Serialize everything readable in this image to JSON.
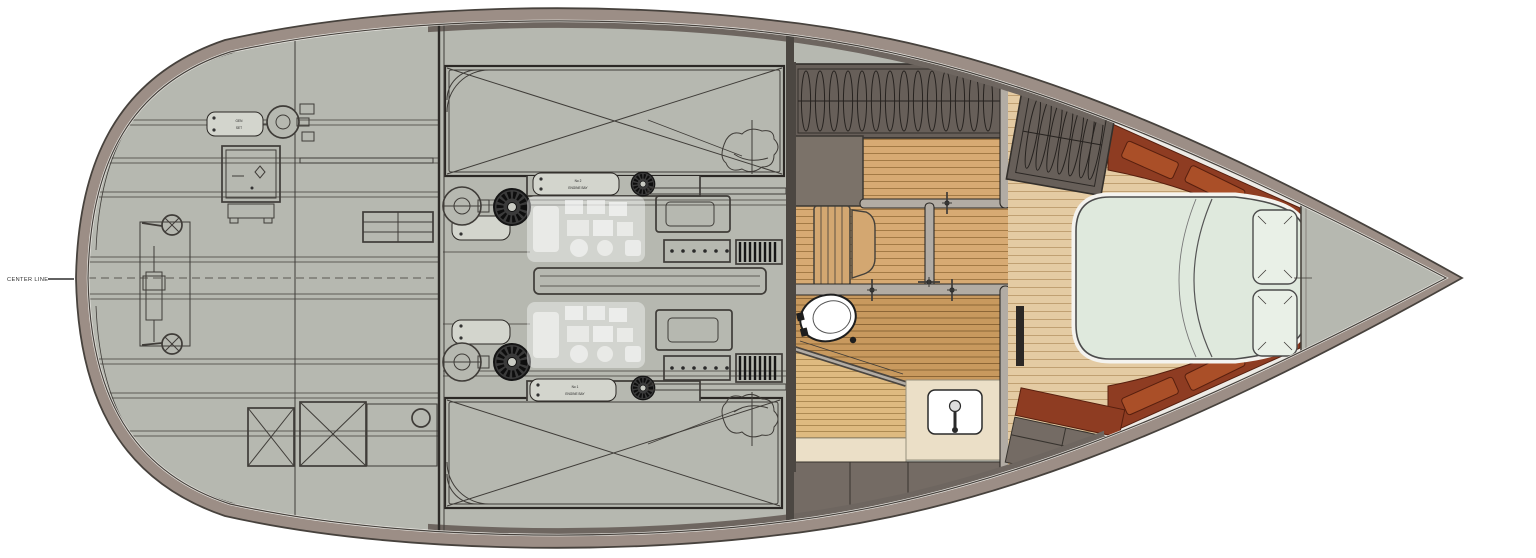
{
  "labels": {
    "center_line": "CENTER LINE",
    "stern_plate_line1": "GEN",
    "stern_plate_line2": "SET",
    "engine_bay_top_line1": "No 2",
    "engine_bay_top_line2": "ENGINE BAY",
    "engine_bay_bottom_line1": "No 1",
    "engine_bay_bottom_line2": "ENGINE BAY"
  },
  "colors": {
    "bg": "#ffffff",
    "deck": "#b6b8b0",
    "deck-light": "#c3c5bd",
    "line": "#3f3c38",
    "line-dark": "#2b2825",
    "rim": "#9c8e86",
    "rim-edge": "#47423d",
    "dark-band": "#6e6660",
    "dark-wall": "#675f59",
    "box-gray": "#7b7269",
    "tube": "#b2aca4",
    "teak-main": "#d7aa73",
    "teak-main-line": "#a37a45",
    "teak-head": "#c8995e",
    "teak-head-line": "#8d6636",
    "grate": "#deba80",
    "grate-line": "#ad8a52",
    "bow-floor": "#e4cba3",
    "bow-floor-line": "#c0a072",
    "cream": "#ebdfc7",
    "cabinet": "#746b64",
    "mahogany": "#8e3c22",
    "mahogany-light": "#aa4f28",
    "mahogany-line": "#571f0e",
    "bed": "#dfe9dd",
    "bed-light": "#e9f0e7",
    "bed-line": "#4c4c4c",
    "window": "#383838",
    "plate": "#d3d5cd"
  }
}
